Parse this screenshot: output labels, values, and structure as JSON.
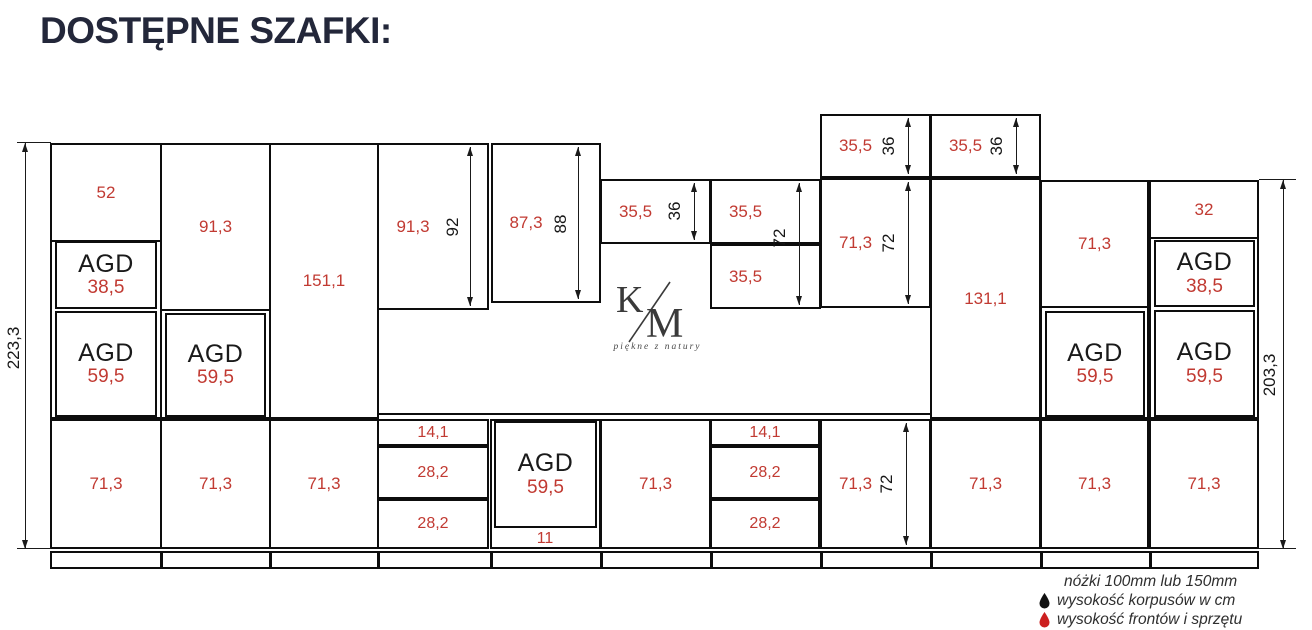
{
  "title": "DOSTĘPNE SZAFKI:",
  "agd": "AGD",
  "totals": {
    "left": "223,3",
    "right": "203,3"
  },
  "columns": {
    "A": {
      "top": "52",
      "agd38": "38,5",
      "agd59": "59,5",
      "base": "71,3"
    },
    "B": {
      "top": "91,3",
      "agd59": "59,5",
      "base": "71,3"
    },
    "C": {
      "tall": "151,1",
      "base": "71,3"
    },
    "D": {
      "top": "91,3",
      "top_dim": "92",
      "drawers": [
        "14,1",
        "28,2",
        "28,2"
      ]
    },
    "E": {
      "top": "87,3",
      "top_dim": "88",
      "agd59": "59,5",
      "drawer": "11"
    },
    "F": {
      "upper": "35,5",
      "upper_dim": "36",
      "base": "71,3"
    },
    "G": {
      "upper1": "35,5",
      "upper2": "35,5",
      "upper_dim": "72",
      "drawers": [
        "14,1",
        "28,2",
        "28,2"
      ]
    },
    "H": {
      "top": "35,5",
      "top_dim": "36",
      "upper": "71,3",
      "upper_dim": "72",
      "base": "71,3",
      "base_dim": "72"
    },
    "I": {
      "top": "35,5",
      "top_dim": "36",
      "tall": "131,1",
      "base": "71,3"
    },
    "J": {
      "upper": "71,3",
      "agd59": "59,5",
      "base": "71,3"
    },
    "K": {
      "top": "32",
      "agd38": "38,5",
      "agd59": "59,5",
      "base": "71,3"
    }
  },
  "logo": {
    "k": "K",
    "m": "M",
    "tagline": "piękne z natury"
  },
  "legend": {
    "line1": "nóżki 100mm lub 150mm",
    "line2": "wysokość korpusów w cm",
    "line3": "wysokość frontów i sprzętu"
  },
  "colors": {
    "red": "#c13a32",
    "line": "#111111",
    "title": "#23273a",
    "legend_black_drop": "#111111",
    "legend_red_drop": "#cc1f1f"
  }
}
